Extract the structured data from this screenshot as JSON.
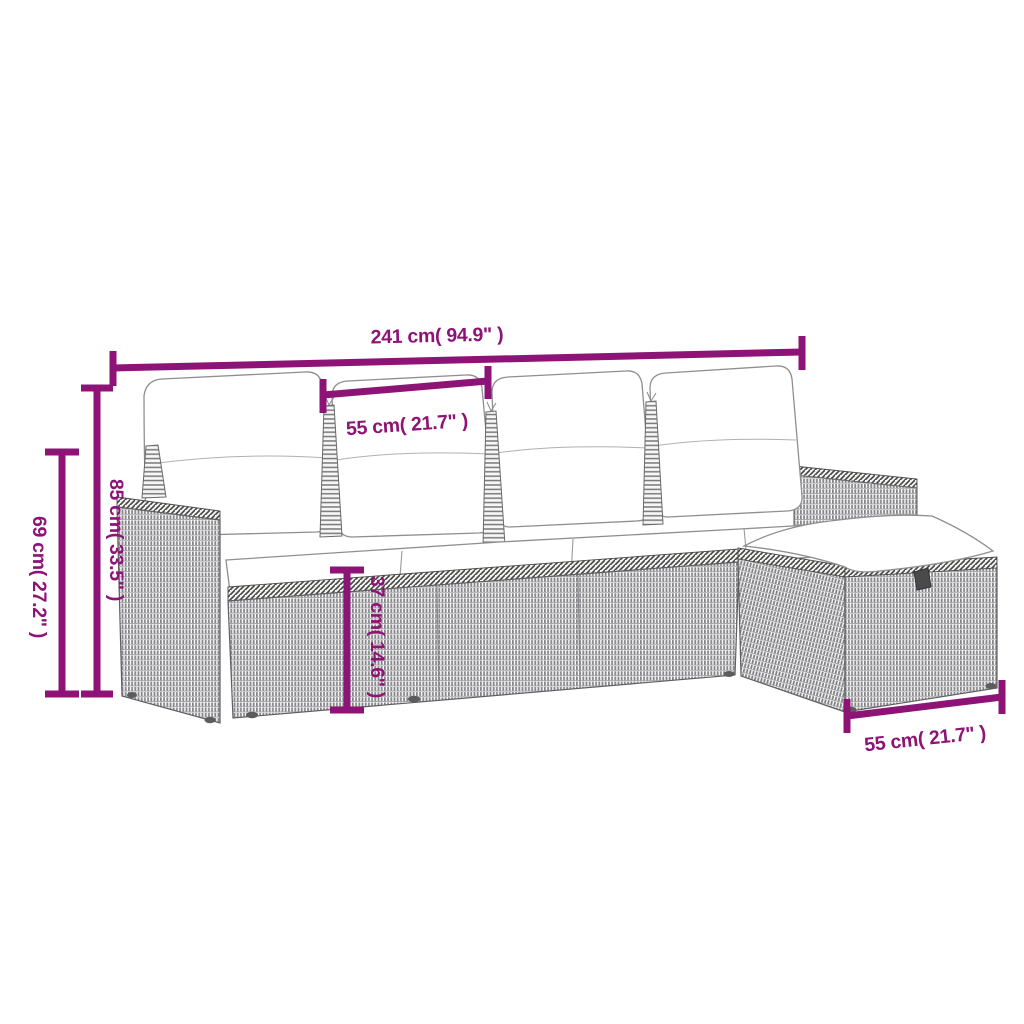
{
  "image": {
    "type": "product-dimension-diagram",
    "subject": "5-piece poly rattan garden sofa set line drawing: 4-seat sofa with back cushions, seat cushions, two armrests and a storage ottoman footstool",
    "background": "#ffffff"
  },
  "colors": {
    "dimension_accent": "#8E1377",
    "drawing_outline": "#6e6e6e",
    "rattan_texture": "#84848a",
    "hatch_band": "#454545",
    "cushion_fill": "#ffffff"
  },
  "dimensions": {
    "overall_width": "241 cm( 94.9\" )",
    "seat_width": "55 cm( 21.7\" )",
    "arm_height": "69 cm( 27.2\" )",
    "back_height": "85 cm( 33.5\" )",
    "seat_height": "37 cm( 14.6\" )",
    "ottoman_width": "55 cm( 21.7\" )"
  }
}
